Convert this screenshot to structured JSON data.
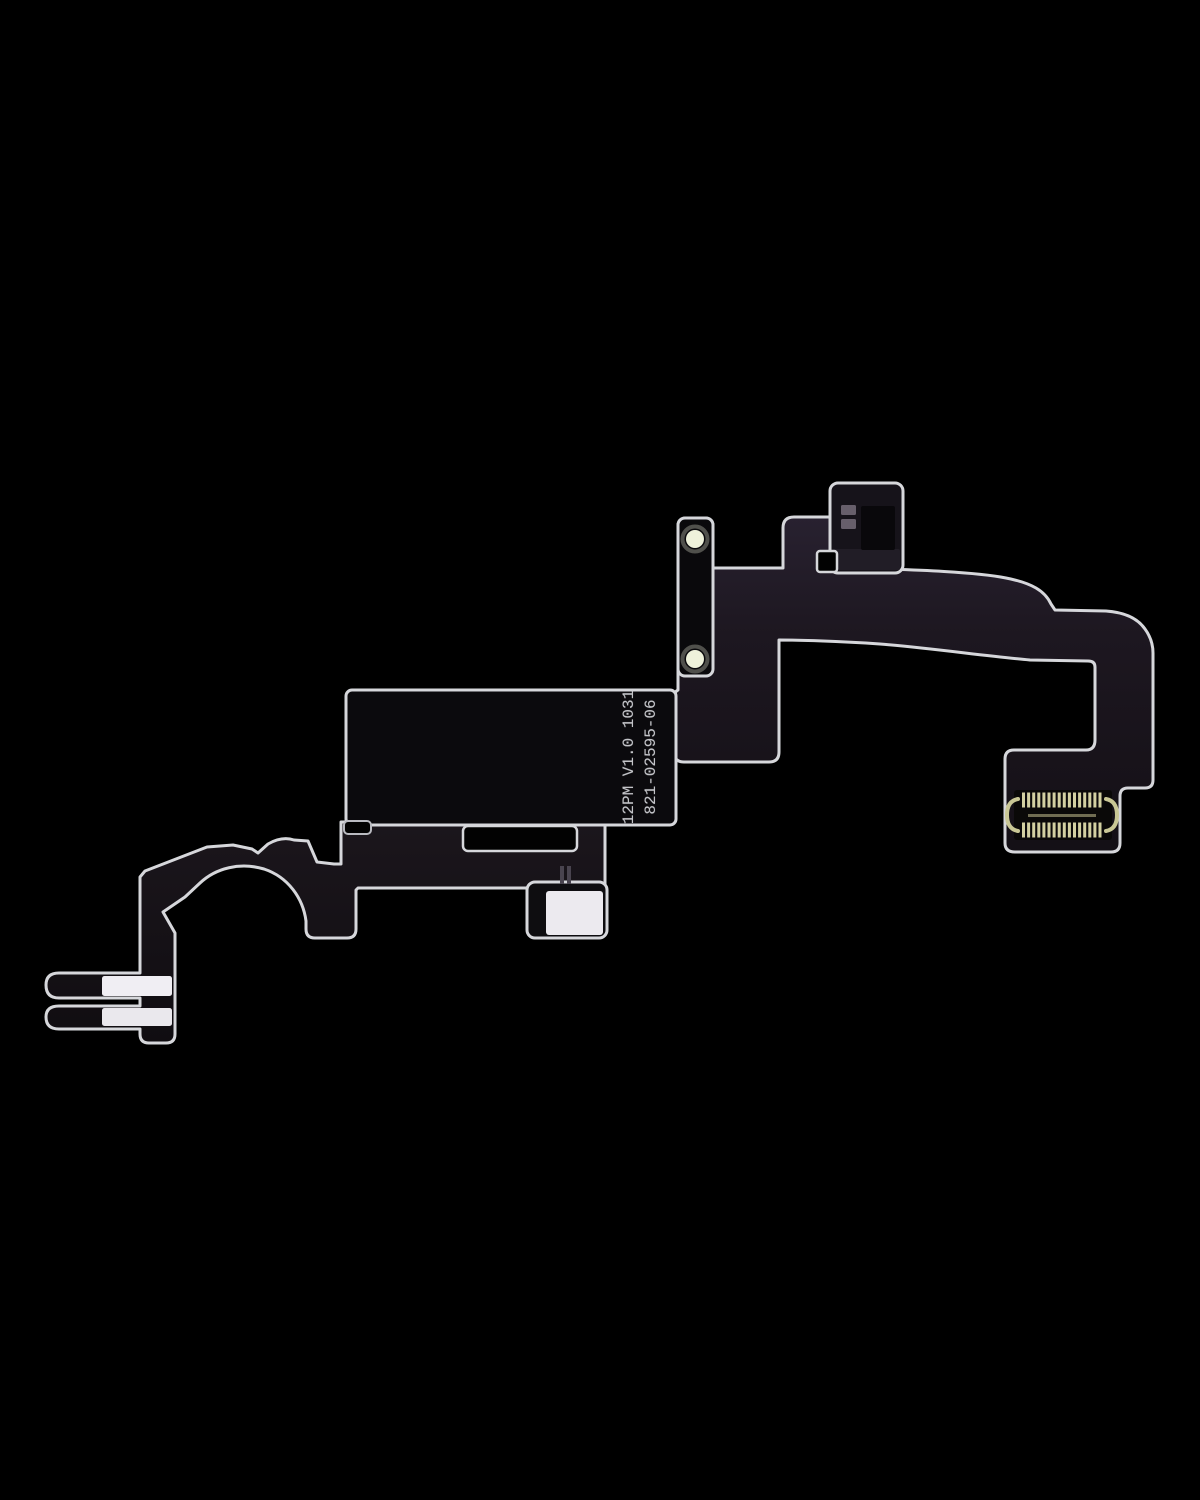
{
  "image": {
    "subject": "Earpiece speaker and proximity sensor flex cable product photo",
    "background": "#000000"
  },
  "labels": {
    "line1": "12PM V1.0 1031",
    "line2": "821-02595-06"
  },
  "colors": {
    "outline": "#d6d7db",
    "flex_body_dark": "#17121a",
    "flex_body_light": "#262029",
    "stiffener": "#0b0a0d",
    "screw_hole": "#eff2db",
    "screw_hole_glow": "#f4f6e1",
    "solder_pad_large": "#eceaef",
    "prong_pad_upper": "#f0eef3",
    "prong_pad_lower": "#eae8ed",
    "pin_gold": "#d2d0a0",
    "pin_gold_dim": "#8a8765",
    "module_body": "#16131a",
    "module_aperture": "#09080b",
    "module_pad": "#675f6b"
  }
}
